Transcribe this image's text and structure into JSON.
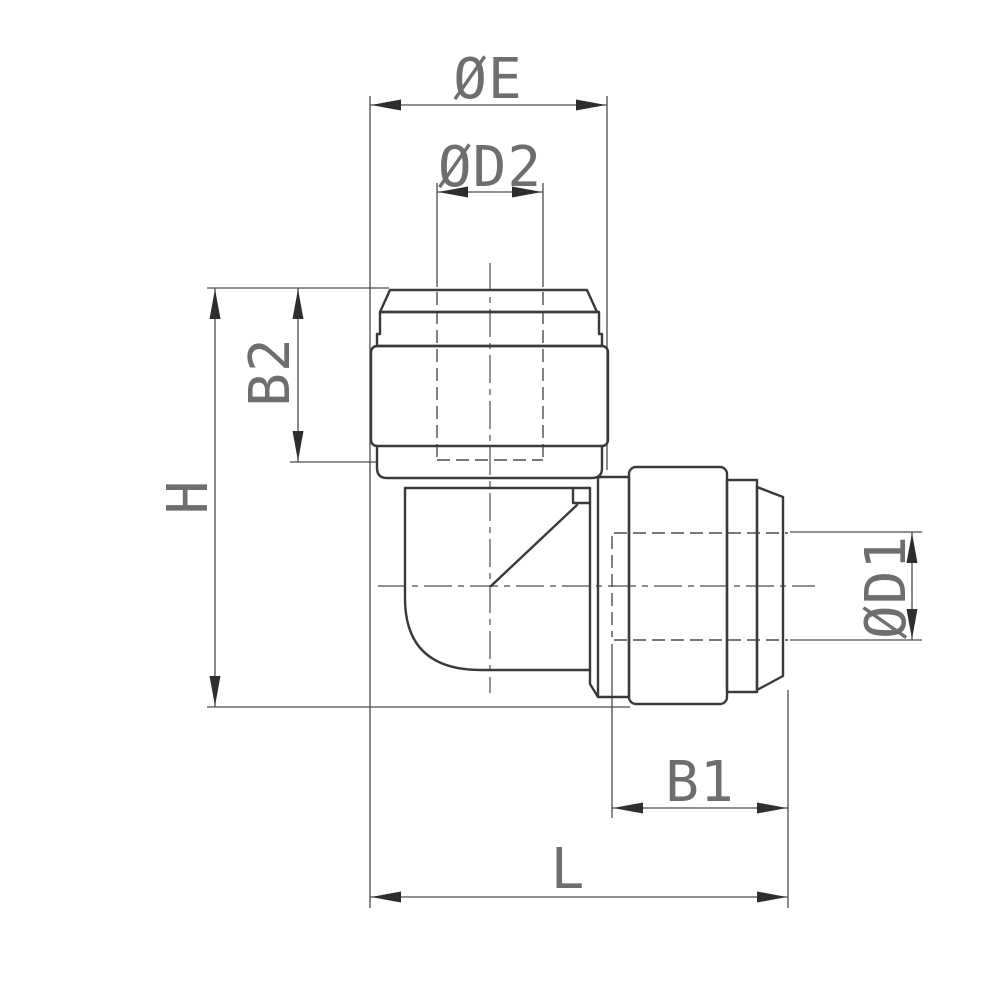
{
  "drawing": {
    "description": "Technical dimension drawing of a push-fit elbow tube fitting, side view",
    "labels": {
      "dia_e": "ØE",
      "dia_d2": "ØD2",
      "b2": "B2",
      "h": "H",
      "dia_d1": "ØD1",
      "b1": "B1",
      "l": "L"
    },
    "colors": {
      "outline": "#3a3a3a",
      "dimension_lines": "#4c4c4c",
      "label_text": "#6e6e6e",
      "background": "#ffffff"
    }
  }
}
